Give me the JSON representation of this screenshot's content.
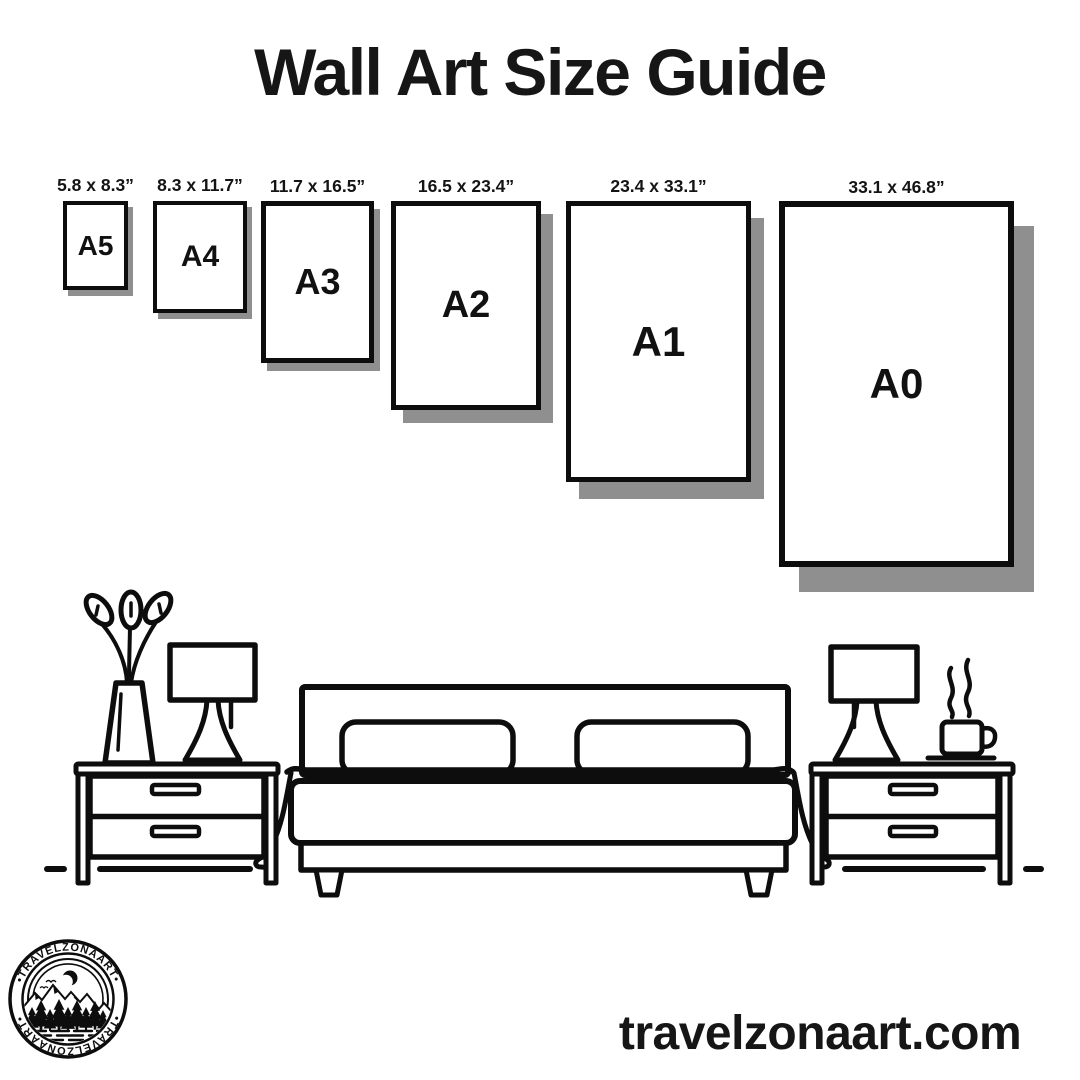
{
  "title": "Wall Art Size Guide",
  "sizes": [
    {
      "name": "A5",
      "dims": "5.8 x 8.3”"
    },
    {
      "name": "A4",
      "dims": "8.3 x 11.7”"
    },
    {
      "name": "A3",
      "dims": "11.7 x 16.5”"
    },
    {
      "name": "A2",
      "dims": "16.5 x 23.4”"
    },
    {
      "name": "A1",
      "dims": "23.4 x 33.1”"
    },
    {
      "name": "A0",
      "dims": "33.1 x 46.8”"
    }
  ],
  "logo": {
    "brand_top": "•TRAVELZONAART•",
    "brand_bottom": "•TRAVELZONAART•"
  },
  "footer": {
    "website": "travelzonaart.com"
  },
  "colors": {
    "ink": "#0d0d0d",
    "shadow": "#8f8f8f",
    "background": "#ffffff"
  }
}
